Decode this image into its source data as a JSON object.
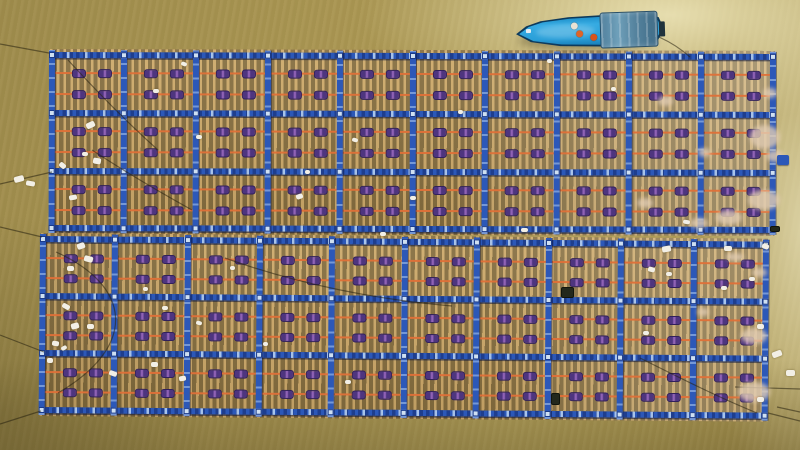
{
  "scene": {
    "description": "Aerial drone view of two large floating aquaculture rafts on muddy river water with a blue work boat and crew at top right",
    "canvas": {
      "width": 800,
      "height": 450
    },
    "palette": {
      "water_base": "#a8944f",
      "water_glint": "#ece4b8",
      "frame_blue": "#2c58b8",
      "frame_dark": "#16317e",
      "slat_tan": "#cda969",
      "slat_gap": "#8d7442",
      "rope_orange": "#df7038",
      "float_purple": "#4e357f",
      "float_magenta": "#8f62b5",
      "node_light": "#cfe0f2",
      "foam_white": "#f2efe6",
      "shell_beige": "#e2cdb4",
      "boat_hull": "#2a9fd8",
      "boat_canopy": "#56849f",
      "vest_orange": "#e06428"
    },
    "rafts": [
      {
        "name": "upper",
        "x": 49,
        "y": 52,
        "width": 727,
        "height": 179,
        "rotation": 0.15,
        "columns": 10,
        "beam_offsets": [
          0,
          58,
          116,
          173
        ],
        "rope_offsets": [
          20,
          41
        ],
        "float_offsets": [
          20,
          46
        ],
        "sheen": "sheen-a"
      },
      {
        "name": "lower",
        "x": 40,
        "y": 236,
        "width": 729,
        "height": 177,
        "rotation": 0.45,
        "columns": 10,
        "beam_offsets": [
          0,
          57,
          114,
          171
        ],
        "rope_offsets": [
          21,
          41
        ],
        "float_offsets": [
          21,
          47
        ],
        "sheen": "sheen-b"
      }
    ],
    "boat": {
      "x": 516,
      "y": 12,
      "width": 146,
      "height": 38,
      "rotation": -2,
      "shadow": [
        518,
        32,
        140,
        18
      ],
      "canopy": [
        84,
        1,
        58,
        36
      ],
      "engine": [
        143,
        12,
        6,
        15
      ],
      "bow_roller": [
        10,
        15,
        5,
        4
      ],
      "people": [
        {
          "name": "crew-member-1",
          "x": 55,
          "y": 10,
          "color": "#e8e2d4"
        },
        {
          "name": "crew-member-2",
          "x": 60,
          "y": 18,
          "color": "#e06428"
        },
        {
          "name": "crew-member-3",
          "x": 74,
          "y": 22,
          "color": "#d8541c"
        }
      ]
    },
    "debris_white": [
      [
        14,
        176,
        10,
        6,
        -15
      ],
      [
        26,
        181,
        9,
        5,
        10
      ],
      [
        86,
        122,
        9,
        6,
        -25
      ],
      [
        93,
        158,
        8,
        6,
        10
      ],
      [
        59,
        163,
        7,
        5,
        40
      ],
      [
        69,
        195,
        8,
        5,
        -10
      ],
      [
        82,
        152,
        6,
        4,
        0
      ],
      [
        153,
        89,
        6,
        4,
        0
      ],
      [
        181,
        62,
        6,
        4,
        20
      ],
      [
        196,
        135,
        6,
        4,
        0
      ],
      [
        296,
        194,
        7,
        5,
        -20
      ],
      [
        305,
        170,
        5,
        4,
        0
      ],
      [
        352,
        138,
        6,
        4,
        15
      ],
      [
        410,
        196,
        6,
        4,
        0
      ],
      [
        458,
        110,
        5,
        4,
        0
      ],
      [
        547,
        59,
        5,
        4,
        0
      ],
      [
        611,
        87,
        5,
        4,
        0
      ],
      [
        521,
        228,
        7,
        4,
        0
      ],
      [
        683,
        220,
        7,
        4,
        10
      ],
      [
        77,
        243,
        8,
        6,
        -20
      ],
      [
        84,
        256,
        9,
        6,
        15
      ],
      [
        67,
        266,
        7,
        5,
        0
      ],
      [
        62,
        304,
        8,
        5,
        30
      ],
      [
        71,
        323,
        8,
        6,
        -15
      ],
      [
        87,
        324,
        7,
        5,
        0
      ],
      [
        52,
        341,
        7,
        5,
        10
      ],
      [
        61,
        346,
        6,
        4,
        -30
      ],
      [
        47,
        358,
        6,
        5,
        0
      ],
      [
        109,
        371,
        8,
        5,
        20
      ],
      [
        151,
        362,
        7,
        5,
        0
      ],
      [
        179,
        376,
        7,
        5,
        -10
      ],
      [
        162,
        306,
        6,
        4,
        0
      ],
      [
        196,
        321,
        6,
        4,
        15
      ],
      [
        143,
        287,
        5,
        4,
        0
      ],
      [
        230,
        266,
        5,
        4,
        0
      ],
      [
        263,
        342,
        5,
        4,
        0
      ],
      [
        345,
        380,
        6,
        4,
        0
      ],
      [
        380,
        232,
        6,
        4,
        0
      ],
      [
        662,
        246,
        9,
        6,
        -10
      ],
      [
        648,
        267,
        7,
        5,
        15
      ],
      [
        666,
        272,
        6,
        4,
        0
      ],
      [
        643,
        331,
        6,
        4,
        0
      ],
      [
        724,
        246,
        8,
        5,
        0
      ],
      [
        762,
        244,
        7,
        5,
        20
      ],
      [
        749,
        277,
        6,
        4,
        0
      ],
      [
        721,
        286,
        6,
        4,
        0
      ],
      [
        757,
        324,
        7,
        5,
        0
      ],
      [
        772,
        351,
        10,
        6,
        -20
      ],
      [
        757,
        397,
        7,
        5,
        0
      ],
      [
        786,
        370,
        9,
        6,
        0
      ]
    ],
    "debris_beige": [
      [
        750,
        125,
        30,
        24
      ],
      [
        748,
        190,
        32,
        20
      ],
      [
        716,
        210,
        26,
        15
      ],
      [
        658,
        96,
        15,
        10
      ],
      [
        698,
        148,
        13,
        9
      ],
      [
        637,
        198,
        16,
        10
      ],
      [
        763,
        88,
        14,
        10
      ],
      [
        690,
        218,
        18,
        10
      ],
      [
        766,
        150,
        18,
        12
      ],
      [
        741,
        328,
        26,
        16
      ],
      [
        738,
        382,
        32,
        20
      ],
      [
        697,
        308,
        12,
        8
      ],
      [
        752,
        268,
        15,
        9
      ],
      [
        726,
        253,
        18,
        8
      ]
    ],
    "dark_objects": [
      [
        561,
        287,
        13,
        11
      ],
      [
        551,
        393,
        9,
        12
      ],
      [
        770,
        226,
        10,
        6
      ]
    ],
    "fittings": [
      [
        777,
        155,
        12,
        10
      ]
    ],
    "anchor_ropes": [
      "M49,53 L0,44",
      "M52,172 C35,176 18,180 0,184",
      "M659,37 C670,42 680,48 690,57",
      "M42,237 L0,227",
      "M44,352 L0,335",
      "M41,411 L0,424",
      "M768,413 L800,421",
      "M777,407 L800,412",
      "M735,387 L800,389",
      "M56,252 C130,285 140,345 58,393",
      "M68,60 C100,95 130,125 158,150",
      "M92,150 C130,175 165,195 192,210",
      "M640,358 C680,378 720,398 757,413",
      "M225,258 C300,285 380,300 452,306"
    ]
  }
}
